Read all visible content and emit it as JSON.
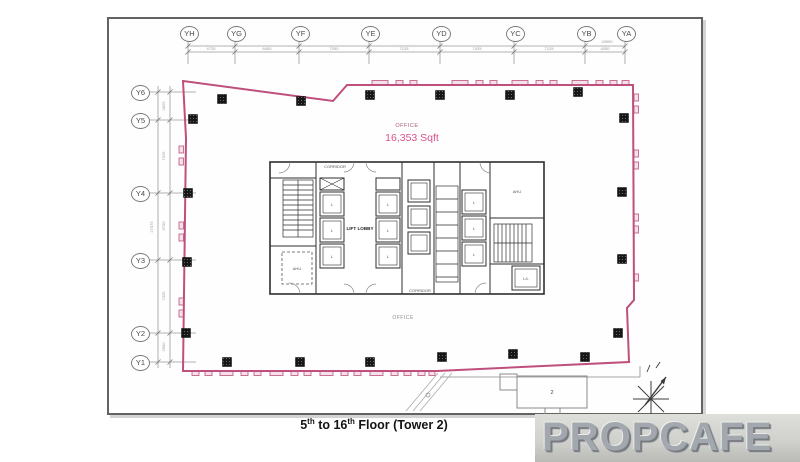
{
  "grid": {
    "top": [
      "YH",
      "YG",
      "YF",
      "YE",
      "YD",
      "YC",
      "YB",
      "YA"
    ],
    "left": [
      "Y6",
      "Y5",
      "Y4",
      "Y3",
      "Y2",
      "Y1"
    ]
  },
  "dims": {
    "top_bays": [
      "4725",
      "6450",
      "7050",
      "7125",
      "7425",
      "7125",
      "4050"
    ],
    "top_overall": "43950",
    "left_bays": [
      "2825",
      "7325",
      "6700",
      "7325",
      "2900"
    ],
    "left_overall": "27075"
  },
  "labels": {
    "office_title": "OFFICE",
    "office_sqft": "16,353 Sqft",
    "office_lower": "OFFICE",
    "lift_lobby": "LIFT LOBBY",
    "corridor_top": "CORRIDOR",
    "corridor_bottom": "CORRIDOR",
    "ahu_left": "AHU",
    "ahu_right": "AHU",
    "service_lift": "L/L",
    "lift_cell": "L",
    "annex": "2"
  },
  "caption": {
    "p1": "5",
    "s1": "th",
    "p2": " to 16",
    "s2": "th",
    "p3": " Floor (Tower 2)"
  },
  "watermark": "PROPCAFE",
  "colors": {
    "outline_pink": "#bf4f7c",
    "area_text_pink": "#d9538e",
    "watermark_text": "#a2a8ad",
    "column_black": "#161616"
  }
}
